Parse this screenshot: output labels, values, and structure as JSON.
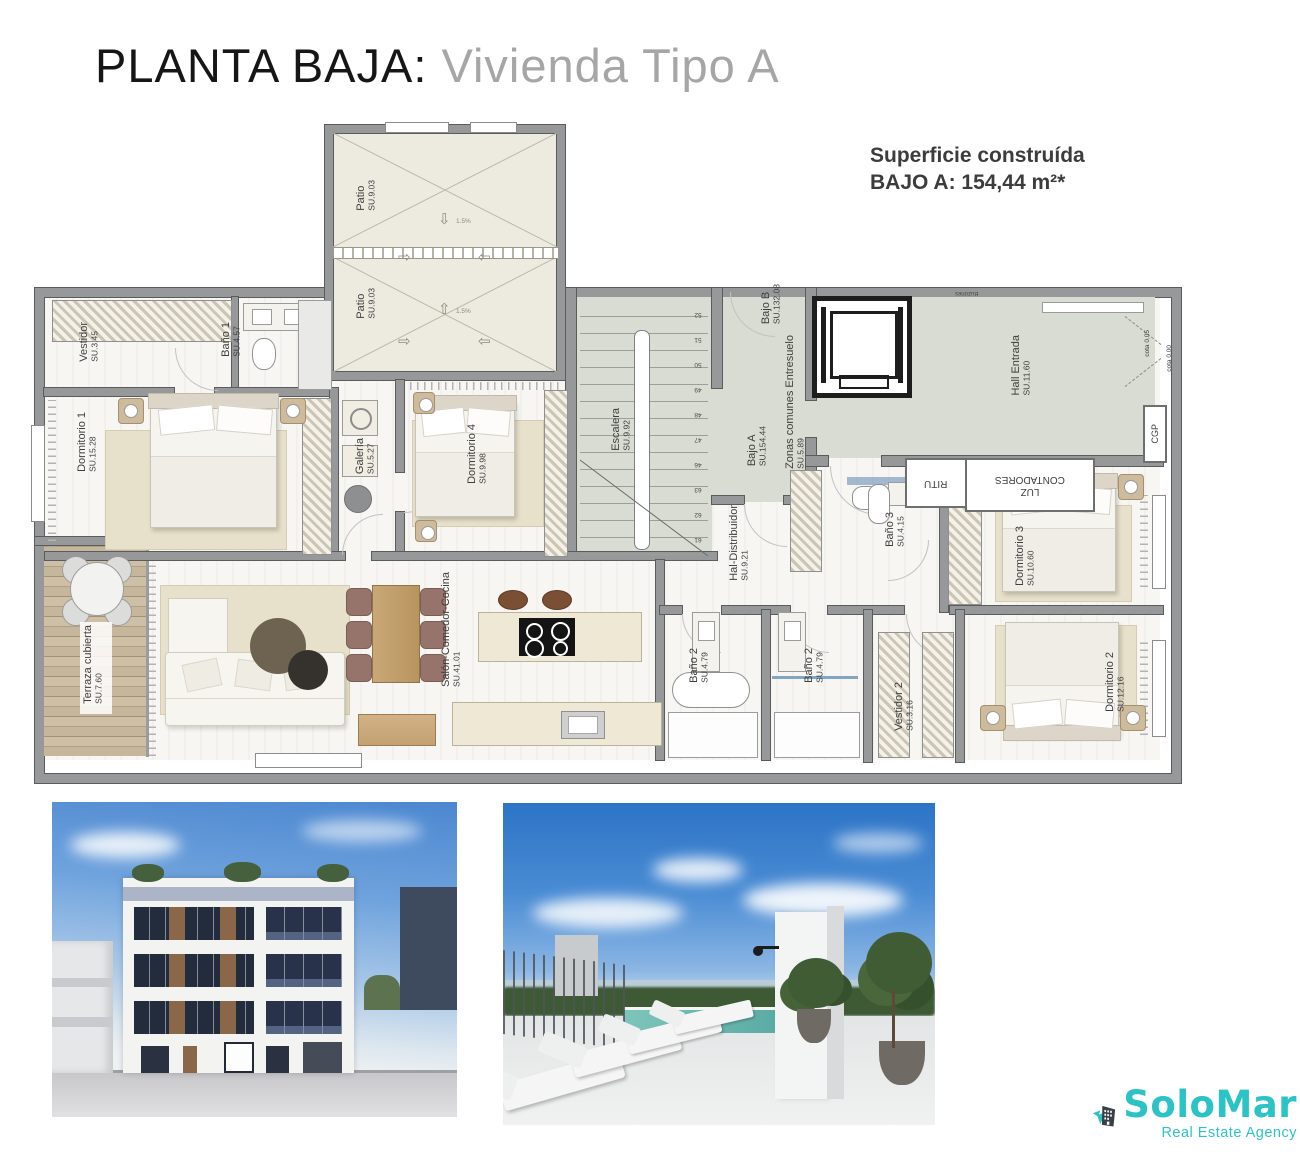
{
  "header": {
    "title_primary": "PLANTA BAJA:",
    "title_secondary": "Vivienda Tipo A",
    "surface_line1": "Superficie construída",
    "surface_line2": "BAJO A: 154,44 m²*"
  },
  "floorplan": {
    "slope_label": "1.5%",
    "rooms": {
      "patio_top": {
        "name": "Patio",
        "su": "SU.9.03"
      },
      "patio_bottom": {
        "name": "Patio",
        "su": "SU.9.03"
      },
      "vestidor1": {
        "name": "Vestidor",
        "su": "SU.3.45"
      },
      "bano1": {
        "name": "Baño 1",
        "su": "SU.4.57"
      },
      "dormitorio1": {
        "name": "Dormitorio 1",
        "su": "SU.15.28"
      },
      "galeria": {
        "name": "Galería",
        "su": "SU.5.27"
      },
      "dormitorio4": {
        "name": "Dormitorio 4",
        "su": "SU.9.98"
      },
      "escalera": {
        "name": "Escalera",
        "su": "SU.9.92"
      },
      "bajo_b": {
        "name": "Bajo B",
        "su": "SU.132.08"
      },
      "bajo_a": {
        "name": "Bajo A",
        "su": "SU.154.44"
      },
      "zonas": {
        "name": "Zonas comunes Entresuelo",
        "su": "SU.5.89"
      },
      "hall": {
        "name": "Hall Entrada",
        "su": "SU.11.60"
      },
      "distribuidor": {
        "name": "Hal-Distribuidor",
        "su": "SU.9.21"
      },
      "bano3": {
        "name": "Baño 3",
        "su": "SU.4.15"
      },
      "dormitorio3": {
        "name": "Dormitorio 3",
        "su": "SU.10.60"
      },
      "terraza": {
        "name": "Terraza cubierta",
        "su": "SU.7.60"
      },
      "salon": {
        "name": "Salón-Comedor-Cocina",
        "su": "SU.41.01"
      },
      "bano2a": {
        "name": "Baño 2",
        "su": "SU.4.79"
      },
      "bano2b": {
        "name": "Baño 2",
        "su": "SU.4.79"
      },
      "vestidor2": {
        "name": "Vestidor 2",
        "su": "SU.3.16"
      },
      "dormitorio2": {
        "name": "Dormitorio 2",
        "su": "SU.12.16"
      }
    },
    "technical": {
      "contadores_line1": "CONTADORES",
      "contadores_line2": "LUZ",
      "ritu": "RITU",
      "cgp": "CGP",
      "cota_a": "cota 0,05",
      "cota_b": "cota 0,00",
      "buzones": "Buzones",
      "stair_numbers": [
        "52",
        "51",
        "50",
        "49",
        "48",
        "47",
        "46",
        "63",
        "62",
        "61"
      ]
    }
  },
  "logo": {
    "name": "SoloMar",
    "tagline": "Real Estate Agency",
    "brand_teal": "#2cc3c7",
    "brand_dark": "#3a4048"
  }
}
